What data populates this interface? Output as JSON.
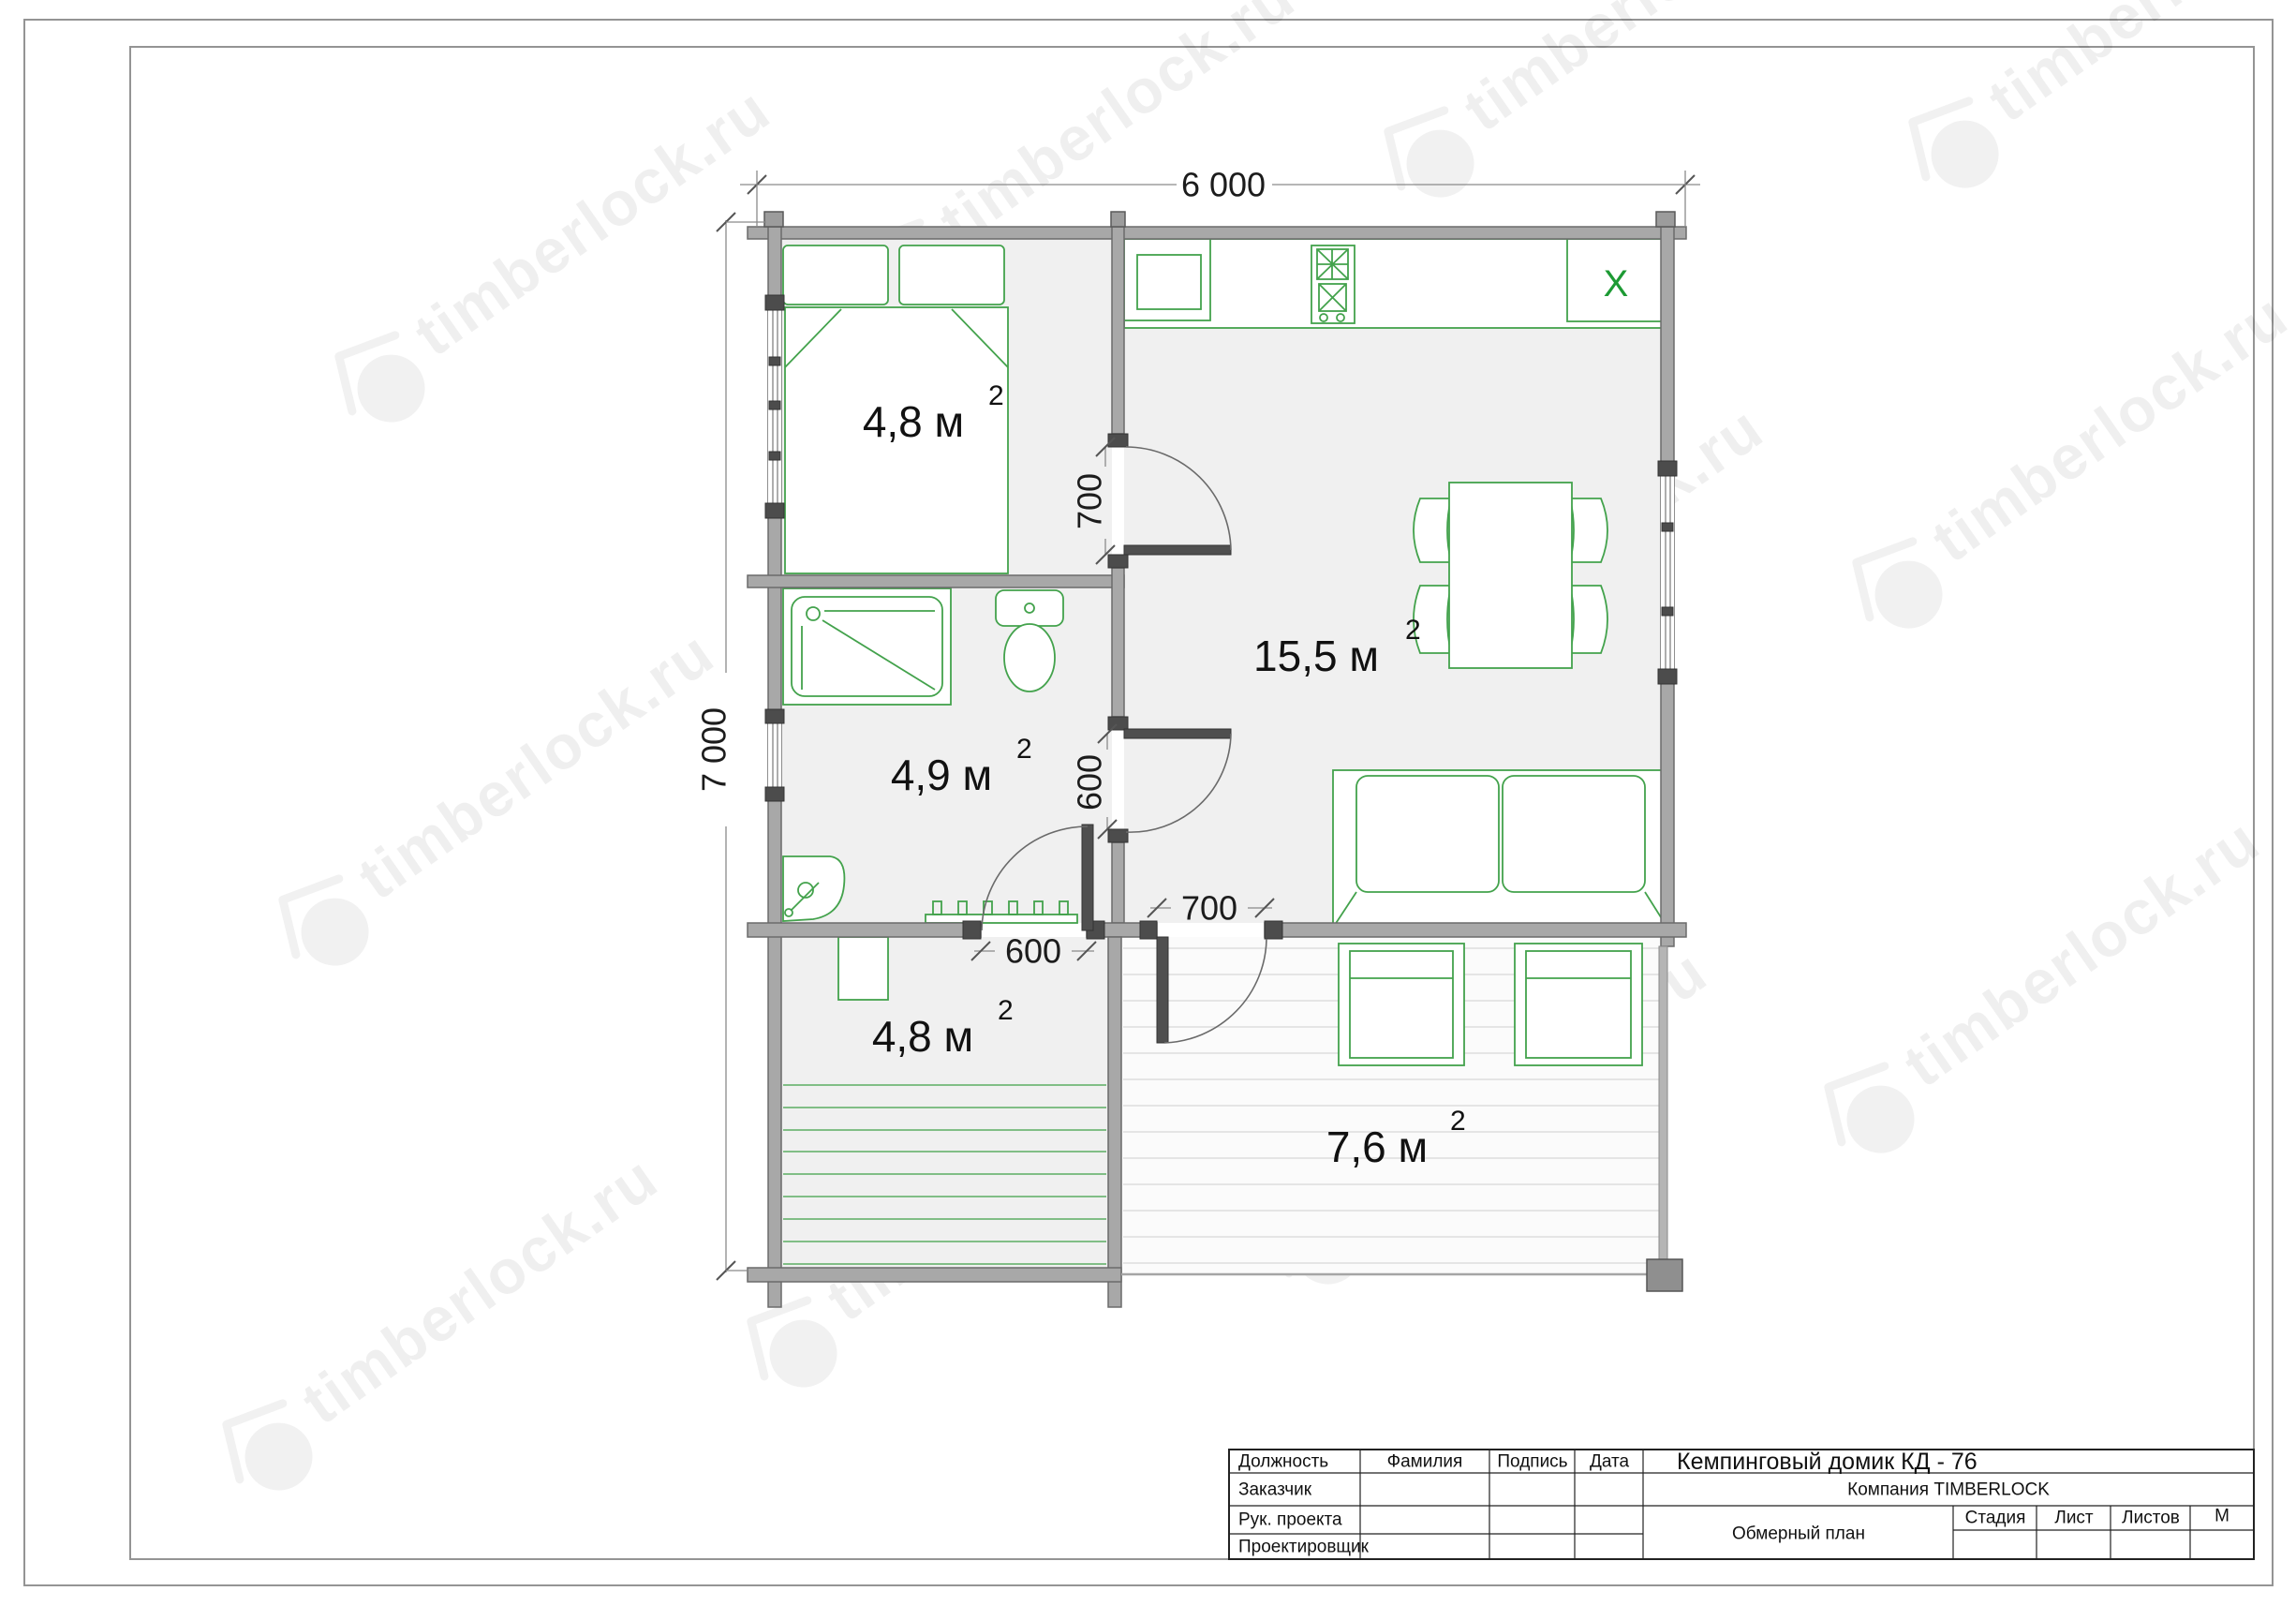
{
  "watermark": {
    "text": "timberlock.ru"
  },
  "plan": {
    "dimensions": {
      "overall_width": "6 000",
      "overall_height": "7 000",
      "bedroom_door": "700",
      "bathroom_door": "600",
      "entry_door": "600",
      "terrace_door": "700"
    },
    "rooms": [
      {
        "name": "bedroom",
        "area": "4,8 м",
        "sup": "2"
      },
      {
        "name": "living-kitchen",
        "area": "15,5 м",
        "sup": "2"
      },
      {
        "name": "bathroom",
        "area": "4,9 м",
        "sup": "2"
      },
      {
        "name": "entry",
        "area": "4,8 м",
        "sup": "2"
      },
      {
        "name": "terrace",
        "area": "7,6 м",
        "sup": "2"
      }
    ],
    "kitchen": {
      "fridge_label": "X"
    }
  },
  "title_block": {
    "col_position": "Должность",
    "col_surname": "Фамилия",
    "col_signature": "Подпись",
    "col_date": "Дата",
    "row_customer": "Заказчик",
    "row_project_lead": "Рук. проекта",
    "row_designer": "Проектировщик",
    "project_title": "Кемпинговый домик   КД - 76",
    "company": "Компания  TIMBERLOCK",
    "drawing_name": "Обмерный план",
    "col_stage": "Стадия",
    "col_sheet": "Лист",
    "col_sheets": "Листов",
    "col_scale": "М"
  }
}
